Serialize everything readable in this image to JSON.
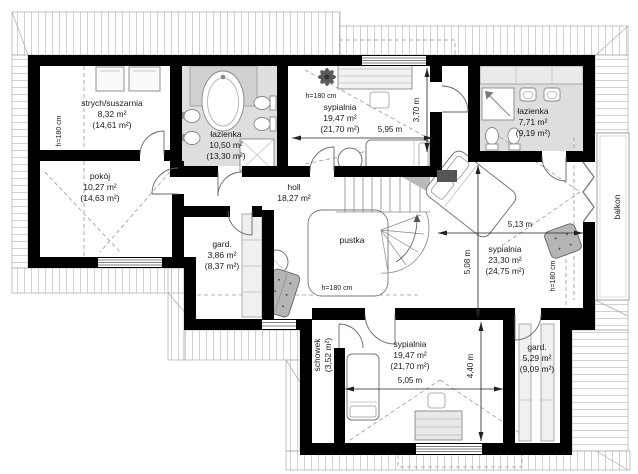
{
  "plan": {
    "rooms": [
      {
        "name": "strych/suszarnia",
        "area": "8,32 m²",
        "area_total": "(14,61 m²)"
      },
      {
        "name": "łazienka",
        "area": "10,50 m²",
        "area_total": "(13,30 m²)"
      },
      {
        "name": "sypialnia",
        "area": "19,47 m²",
        "area_total": "(21,70 m²)"
      },
      {
        "name": "łazienka",
        "area": "7,71 m²",
        "area_total": "(9,19 m²)"
      },
      {
        "name": "pokój",
        "area": "10,27 m²",
        "area_total": "(14,63 m²)"
      },
      {
        "name": "holl",
        "area": "18,27 m²",
        "area_total": ""
      },
      {
        "name": "gard.",
        "area": "3,86 m²",
        "area_total": "(8,37 m²)"
      },
      {
        "name": "pustka",
        "area": "",
        "area_total": ""
      },
      {
        "name": "sypialnia",
        "area": "23,30 m²",
        "area_total": "(24,75 m²)"
      },
      {
        "name": "schowek",
        "area": "(3,52 m²)",
        "area_total": ""
      },
      {
        "name": "sypialnia",
        "area": "19,47 m²",
        "area_total": "(21,70 m²)"
      },
      {
        "name": "gard.",
        "area": "5,29 m²",
        "area_total": "(9,09 m²)"
      },
      {
        "name": "balkon",
        "area": "",
        "area_total": ""
      }
    ],
    "dimensions": {
      "bedroom1_width": "5,95 m",
      "bedroom1_depth": "3,70 m",
      "bedroom2_width": "5,13 m",
      "bedroom2_depth": "5,08 m",
      "bedroom3_width": "5,05 m",
      "bedroom3_depth": "4,40 m"
    },
    "height_label": "h=180 cm"
  }
}
